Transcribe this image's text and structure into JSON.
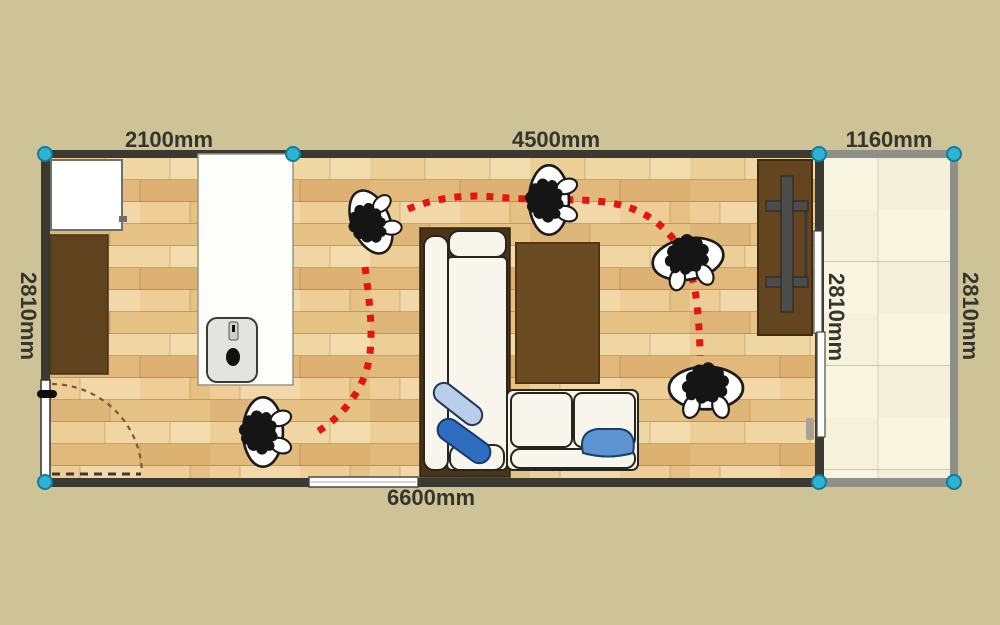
{
  "floorplan": {
    "dimension_labels": {
      "top_section_1": "2100mm",
      "top_section_2": "4500mm",
      "top_section_3": "1160mm",
      "bottom_total": "6600mm",
      "left_height": "2810mm",
      "divider_height": "2810mm",
      "right_height": "2810mm"
    },
    "rooms": [
      {
        "name": "living-dining-kitchen",
        "floor": "wood-plank"
      },
      {
        "name": "balcony",
        "floor": "cream-tile"
      }
    ],
    "furniture": [
      "refrigerator",
      "wall-cabinet",
      "kitchen-counter",
      "sink",
      "corner-sofa",
      "blue-cushions",
      "area-rug",
      "tv-stand",
      "hinged-door",
      "window",
      "sliding-door"
    ],
    "people_count": 5,
    "route": {
      "style": "red-dotted",
      "segments": 2,
      "color": "#e51414"
    },
    "markers": {
      "shape": "circle",
      "count": 7,
      "color": "#2eb3d3"
    },
    "colors": {
      "background": "#cec396",
      "wall_dark": "#3a3a32",
      "wall_gray": "#8f8f89",
      "wood_light": "#f0d7a4",
      "wood_dark": "#dcb172",
      "furniture_brown": "#5e431e",
      "sofa_white": "#f8f6ec",
      "cushion_dark_blue": "#2e6dbf",
      "cushion_light_blue": "#b9cfe9"
    }
  }
}
